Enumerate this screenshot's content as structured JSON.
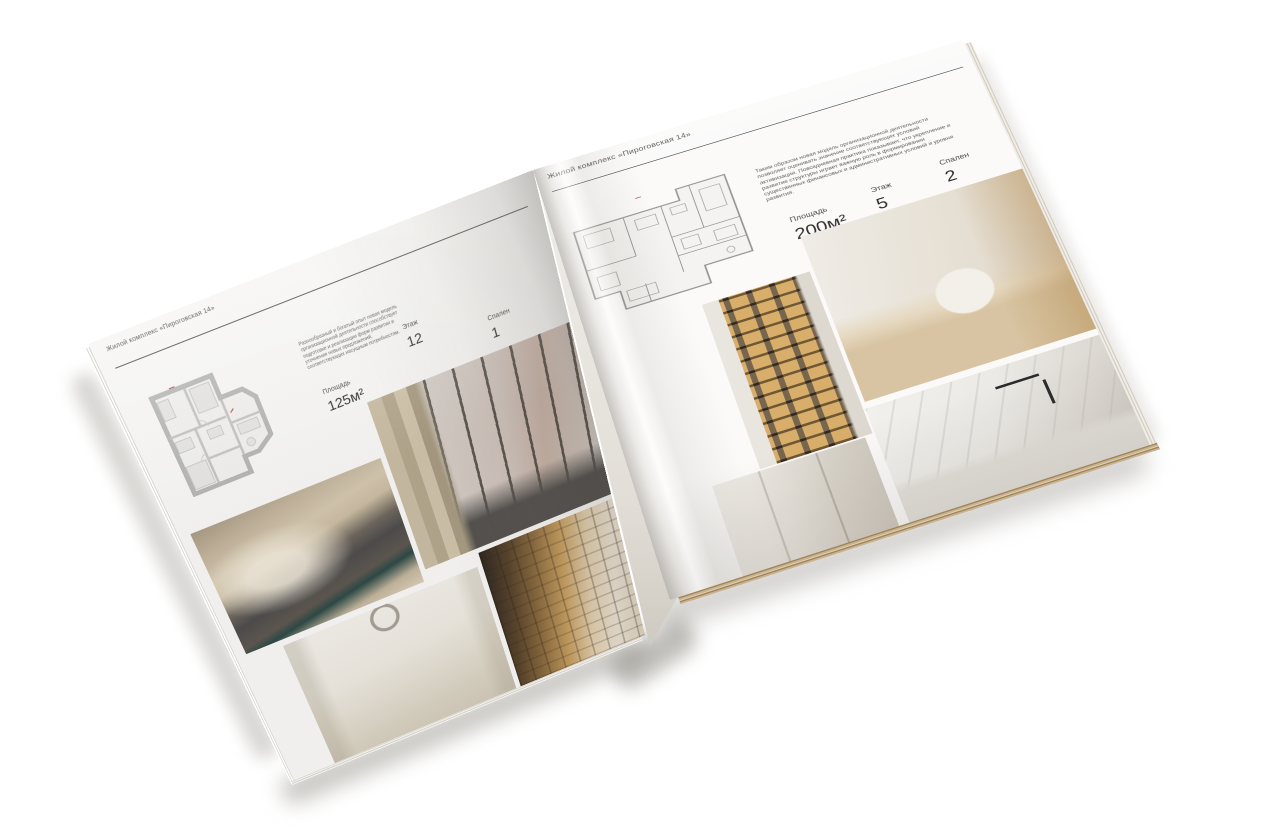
{
  "brand_color": "#4a4a4a",
  "paper_color": "#f6f5f3",
  "left_page": {
    "header": "Жилой комплекс «Пироговская 14»",
    "description": "Разнообразный и богатый опыт новая модель организационной деятельности способствует подготовке и реализации форм развития и уточнения новых предложений, соответствующих насущным потребностям.",
    "stats": [
      {
        "label": "Площадь",
        "value": "125м²"
      },
      {
        "label": "Этаж",
        "value": "12"
      },
      {
        "label": "Спален",
        "value": "1"
      }
    ],
    "photos": [
      {
        "name": "bedroom-photo",
        "subject": "beige master bedroom"
      },
      {
        "name": "living-room-photo",
        "subject": "living room with panoramic windows"
      },
      {
        "name": "white-bedroom-photo",
        "subject": "white bedroom with bench"
      },
      {
        "name": "corridor-library-photo",
        "subject": "corridor with backlit shelving"
      }
    ]
  },
  "right_page": {
    "header": "Жилой комплекс «Пироговская 14»",
    "description": "Таким образом новая модель организационной деятельности позволяет оценивать значение соответствующих условий активизации. Повседневная практика показывает, что укрепление и развитие структуры играет важную роль в формировании существенных финансовых и административных условий и уровня развития.",
    "stats": [
      {
        "label": "Площадь",
        "value": "200м²"
      },
      {
        "label": "Этаж",
        "value": "5"
      },
      {
        "label": "Спален",
        "value": "2"
      }
    ],
    "photos": [
      {
        "name": "wardrobe-photo",
        "subject": "backlit wardrobe cabinet"
      },
      {
        "name": "dressing-room-photo",
        "subject": "dressing room with island"
      },
      {
        "name": "hallway-photo",
        "subject": "light hallway"
      },
      {
        "name": "bathroom-photo",
        "subject": "marble bathroom with black faucet"
      }
    ]
  }
}
